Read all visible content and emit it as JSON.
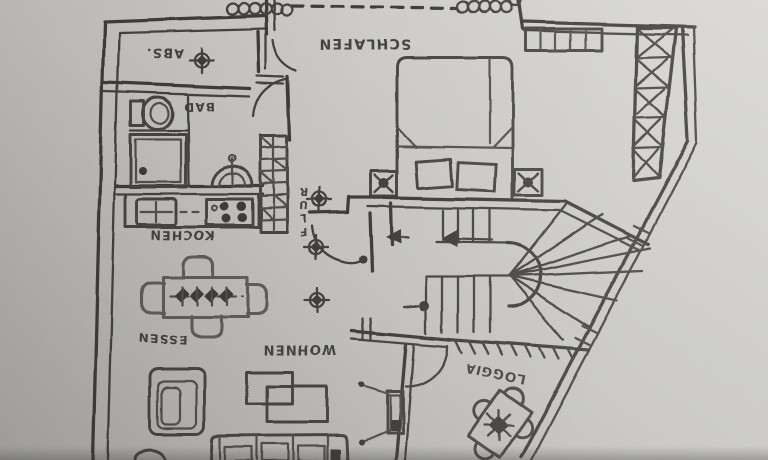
{
  "rooms": {
    "schlafen": "SCHLAFEN",
    "abstellraum": "ABS.",
    "bad": "BAD",
    "kochen": "KOCHEN",
    "flur": "FLUR",
    "essen": "ESSEN",
    "wohnen": "WOHNEN",
    "loggia": "LOGGIA"
  },
  "colors": {
    "ink": "#34322f",
    "paper_light": "#d8d7d5",
    "paper_dark": "#a5a4a2"
  }
}
